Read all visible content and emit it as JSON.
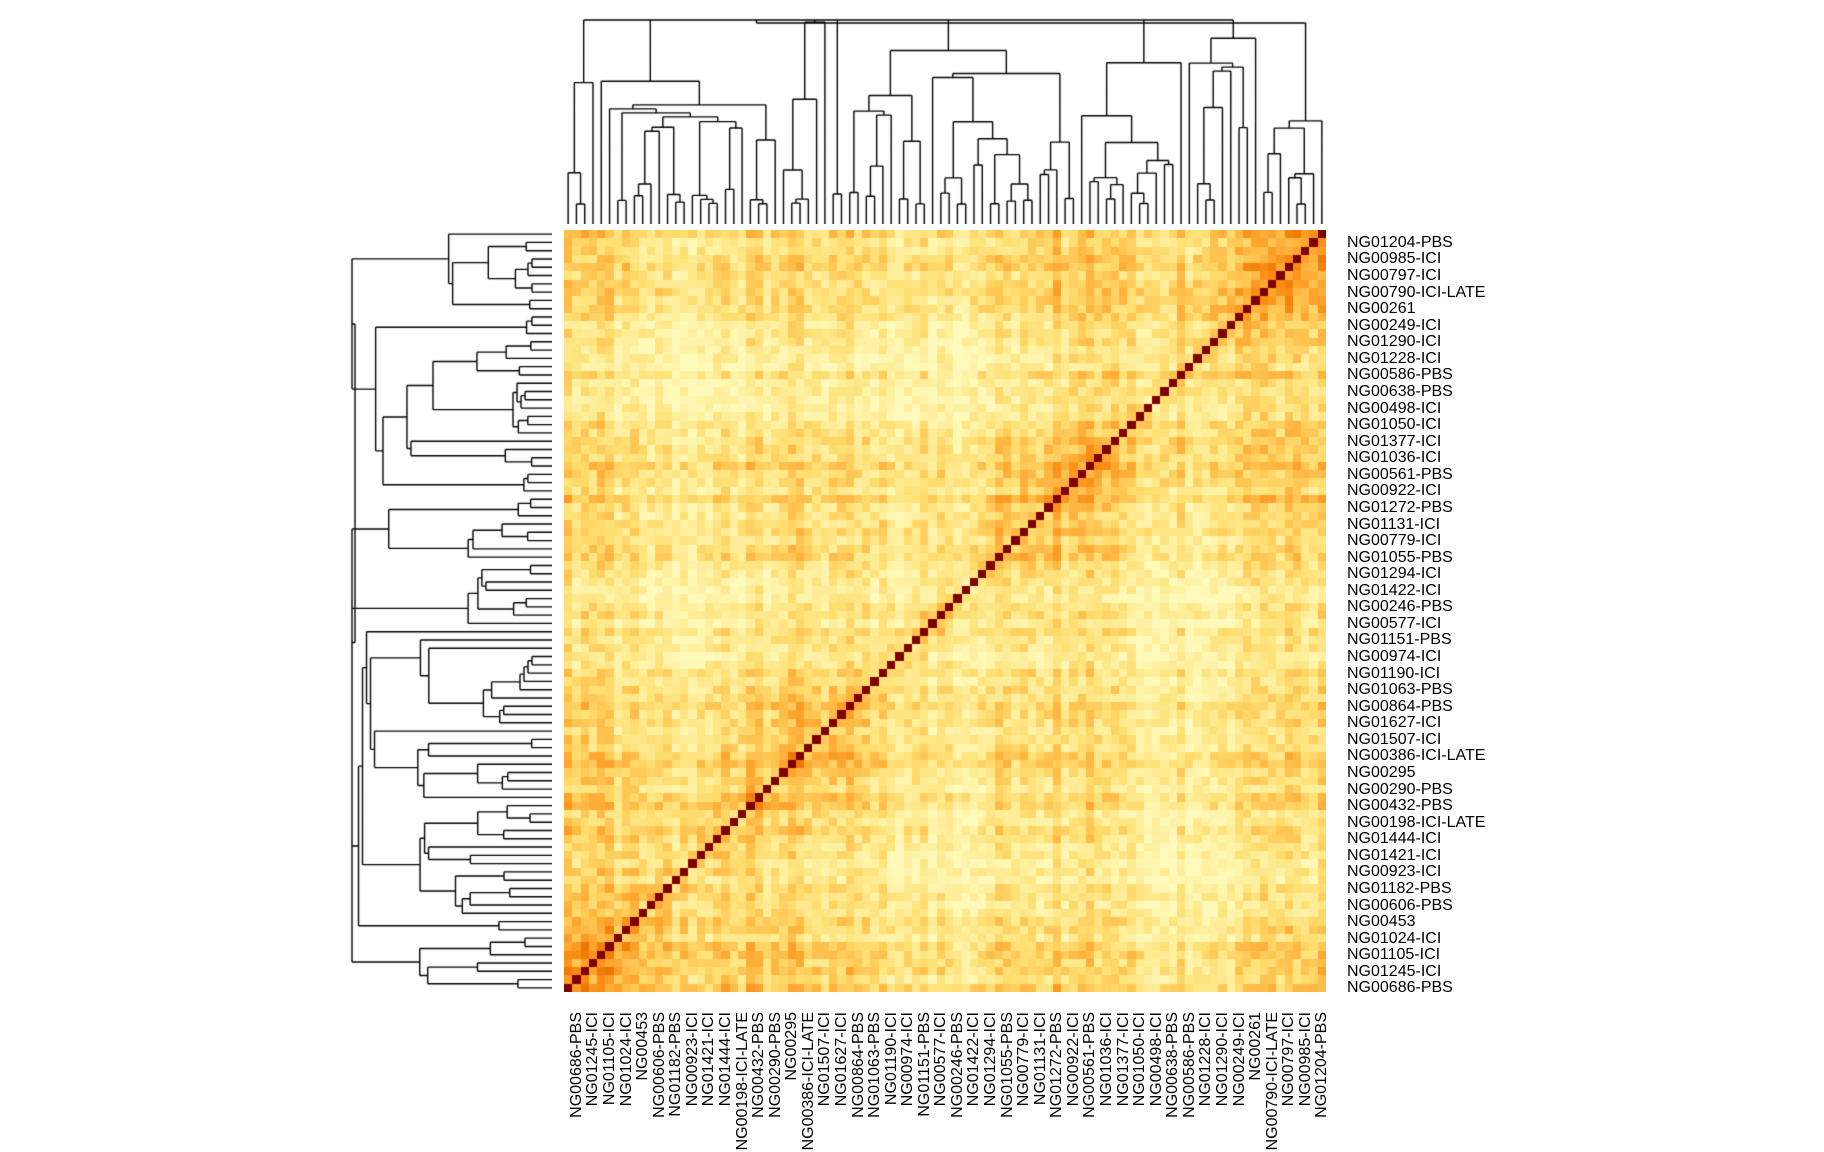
{
  "chart_data": {
    "type": "heatmap",
    "title": "",
    "description_of_visible_content": "Hierarchically clustered square heatmap with column dendrogram on top, row dendrogram on left, row labels on right, rotated column labels on bottom; dark red diagonal runs from top-right to bottom-left",
    "matrix_size": 92,
    "rows_per_label": 2,
    "row_labels": [
      "NG01204-PBS",
      "NG00985-ICI",
      "NG00797-ICI",
      "NG00790-ICI-LATE",
      "NG00261",
      "NG00249-ICI",
      "NG01290-ICI",
      "NG01228-ICI",
      "NG00586-PBS",
      "NG00638-PBS",
      "NG00498-ICI",
      "NG01050-ICI",
      "NG01377-ICI",
      "NG01036-ICI",
      "NG00561-PBS",
      "NG00922-ICI",
      "NG01272-PBS",
      "NG01131-ICI",
      "NG00779-ICI",
      "NG01055-PBS",
      "NG01294-ICI",
      "NG01422-ICI",
      "NG00246-PBS",
      "NG00577-ICI",
      "NG01151-PBS",
      "NG00974-ICI",
      "NG01190-ICI",
      "NG01063-PBS",
      "NG00864-PBS",
      "NG01627-ICI",
      "NG01507-ICI",
      "NG00386-ICI-LATE",
      "NG00295",
      "NG00290-PBS",
      "NG00432-PBS",
      "NG00198-ICI-LATE",
      "NG01444-ICI",
      "NG01421-ICI",
      "NG00923-ICI",
      "NG01182-PBS",
      "NG00606-PBS",
      "NG00453",
      "NG01024-ICI",
      "NG01105-ICI",
      "NG01245-ICI",
      "NG00686-PBS"
    ],
    "column_labels": [
      "NG00686-PBS",
      "NG01245-ICI",
      "NG01105-ICI",
      "NG01024-ICI",
      "NG00453",
      "NG00606-PBS",
      "NG01182-PBS",
      "NG00923-ICI",
      "NG01421-ICI",
      "NG01444-ICI",
      "NG00198-ICI-LATE",
      "NG00432-PBS",
      "NG00290-PBS",
      "NG00295",
      "NG00386-ICI-LATE",
      "NG01507-ICI",
      "NG01627-ICI",
      "NG00864-PBS",
      "NG01063-PBS",
      "NG01190-ICI",
      "NG00974-ICI",
      "NG01151-PBS",
      "NG00577-ICI",
      "NG00246-PBS",
      "NG01422-ICI",
      "NG01294-ICI",
      "NG01055-PBS",
      "NG00779-ICI",
      "NG01131-ICI",
      "NG01272-PBS",
      "NG00922-ICI",
      "NG00561-PBS",
      "NG01036-ICI",
      "NG01377-ICI",
      "NG01050-ICI",
      "NG00498-ICI",
      "NG00638-PBS",
      "NG00586-PBS",
      "NG01228-ICI",
      "NG01290-ICI",
      "NG00249-ICI",
      "NG00261",
      "NG00790-ICI-LATE",
      "NG00797-ICI",
      "NG00985-ICI",
      "NG01204-PBS"
    ],
    "column_order": "reverse_of_row_order",
    "diagonal_value": 1.0,
    "offdiagonal_value_range": [
      0.06,
      0.8
    ],
    "value_model": {
      "base": 0.34,
      "near_diagonal_boost": 0.15,
      "near_diagonal_decay": 7,
      "distance_fade": 0.0011,
      "noise_amplitude": 0.24,
      "symmetric": true
    },
    "palette_stops": [
      [
        0.0,
        "#FFFFC9"
      ],
      [
        0.18,
        "#FFF0A0"
      ],
      [
        0.32,
        "#FFDF72"
      ],
      [
        0.45,
        "#FFBE4A"
      ],
      [
        0.55,
        "#FFA52E"
      ],
      [
        0.65,
        "#F88910"
      ],
      [
        0.74,
        "#E86E00"
      ],
      [
        0.82,
        "#C94602"
      ],
      [
        0.9,
        "#A51803"
      ],
      [
        1.0,
        "#7E0000"
      ]
    ],
    "dendrogram_color": "#000000",
    "background_color": "#FFFFFF",
    "label_color": "#000000",
    "legend": "none",
    "grid": false,
    "generation_seeds": {
      "matrix": 42,
      "top_dendrogram": 7,
      "left_dendrogram": 13
    }
  }
}
